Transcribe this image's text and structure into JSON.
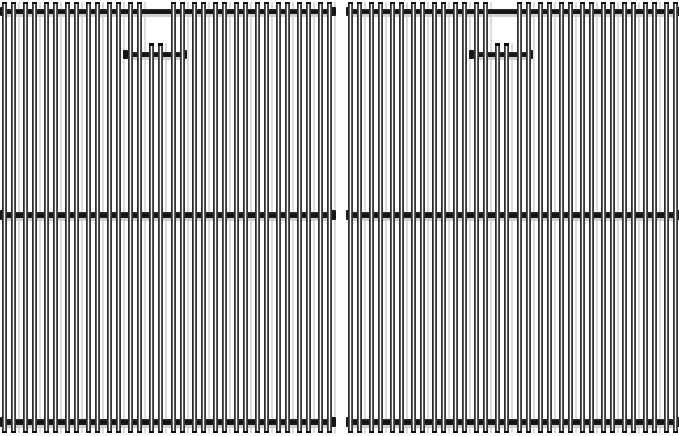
{
  "scene": {
    "description": "Product photo of two matching stainless steel grill cooking grates side by side on a plain white background",
    "object_count": 2,
    "background_color": "#ffffff",
    "grates": [
      {
        "id": "left-grate",
        "x": 0
      },
      {
        "id": "right-grate",
        "x": 346
      }
    ],
    "grate_spec": {
      "width": 336,
      "height": 436,
      "rod_pairs": 16,
      "pair_first_center": 9,
      "pair_pitch": 21.0667,
      "rod_width": 5,
      "pair_inner_gap": 4,
      "rod_top": 2,
      "rod_bottom": 433,
      "notch_pair_index": 7,
      "notch_rod_top": 43,
      "crossbars": [
        {
          "y": 9,
          "h": 5
        },
        {
          "y": 212,
          "h": 6
        },
        {
          "y": 419,
          "h": 6
        }
      ],
      "bracket": {
        "bar_x": 126,
        "bar_w": 58,
        "bar_y": 52,
        "bar_h": 5,
        "cap_w": 5,
        "cap_h": 9
      }
    },
    "colors": {
      "rod_edge": "#1d1d1d",
      "rod_highlight": "#ffffff",
      "crossbar_dark": "#0e0e0e",
      "shadow_gray": "#bdbdbd",
      "background": "#ffffff"
    }
  }
}
